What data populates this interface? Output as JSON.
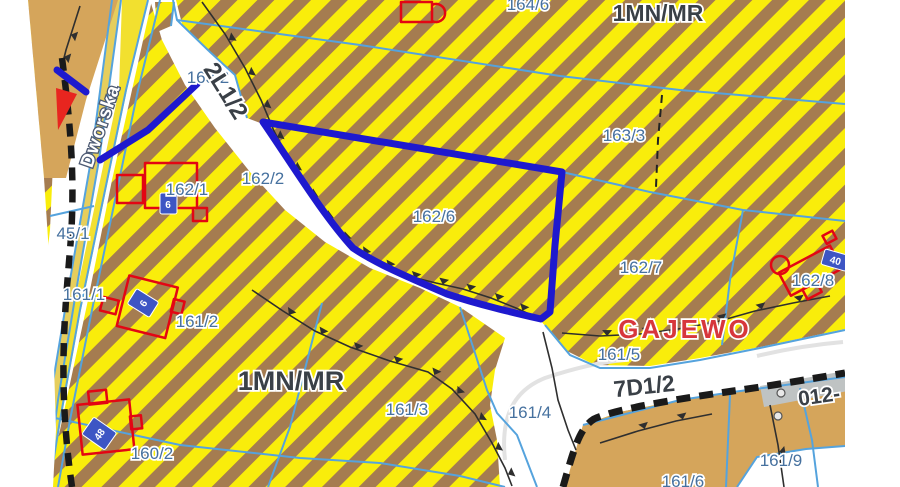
{
  "map": {
    "street_name": "Dworska",
    "place_name": "GAJEWO",
    "selected_parcel": "162/6",
    "zones": {
      "zone_top_right": "1MN/MR",
      "zone_center_left": "1MN/MR",
      "road_2l": "2L1/2",
      "road_7d": "7D1/2",
      "road_012": "012-"
    },
    "parcels": {
      "p45_1": "45/1",
      "p160_2": "160/2",
      "p161_1": "161/1",
      "p161_2": "161/2",
      "p161_3": "161/3",
      "p161_4": "161/4",
      "p161_5": "161/5",
      "p161_6": "161/6",
      "p161_9": "161/9",
      "p162_1": "162/1",
      "p162_2": "162/2",
      "p162_6": "162/6",
      "p162_7": "162/7",
      "p162_8": "162/8",
      "p163_2": "163/2",
      "p163_3": "163/3",
      "p164_6": "164/6"
    },
    "address_plates": {
      "plate_162_1": "6",
      "plate_161_2": "6",
      "plate_160_2": "48",
      "plate_162_8": "40"
    },
    "colors": {
      "stripe_yellow": "#F9ED0B",
      "stripe_brown": "#A57C50",
      "tan_area": "#D5A55B",
      "road_yellow": "#F2E02F",
      "road_yellow_pale": "#E6CE5C",
      "cadastral_line": "#55A3DD",
      "highlight_blue": "#1E19CE",
      "building_red": "#E30613",
      "plate_blue": "#3D55C4",
      "parcel_label": "#46719F",
      "zone_label": "#3A4047",
      "place_label": "#D7373C",
      "boundary_black": "#1A1A1A",
      "road_gray": "#BFC3C3"
    }
  }
}
